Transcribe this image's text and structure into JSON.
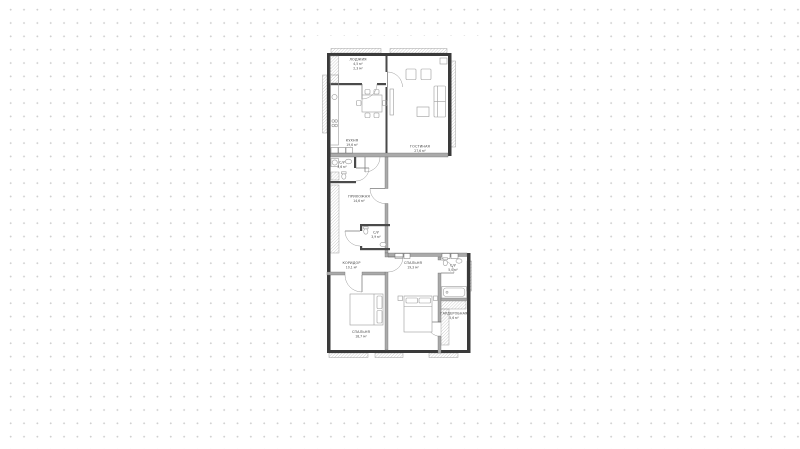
{
  "plan": {
    "title": "floor-plan",
    "rooms": [
      {
        "name": "лоджия",
        "area": "4,5 м²",
        "area2": "2,3 м²"
      },
      {
        "name": "кухня",
        "area": "19,6 м²"
      },
      {
        "name": "гостиная",
        "area": "27,6 м²"
      },
      {
        "name": "с/у",
        "area": "3,6 м²"
      },
      {
        "name": "прихожая",
        "area": "14,6 м²"
      },
      {
        "name": "с/у",
        "area": "3,9 м²"
      },
      {
        "name": "коридор",
        "area": "10,1 м²"
      },
      {
        "name": "спальня",
        "area": "19,3 м²"
      },
      {
        "name": "с/у",
        "area": "5,0 м²"
      },
      {
        "name": "гардеробная",
        "area": "5,6 м²"
      },
      {
        "name": "спальня",
        "area": "18,7 м²"
      }
    ],
    "colors": {
      "wall_dark": "#3a3a3a",
      "wall_concrete": "#aaaaaa",
      "furniture_line": "#9b9b9b",
      "label_text": "#454545",
      "background_dot": "#d0d0d0",
      "plan_background": "#ffffff"
    }
  }
}
